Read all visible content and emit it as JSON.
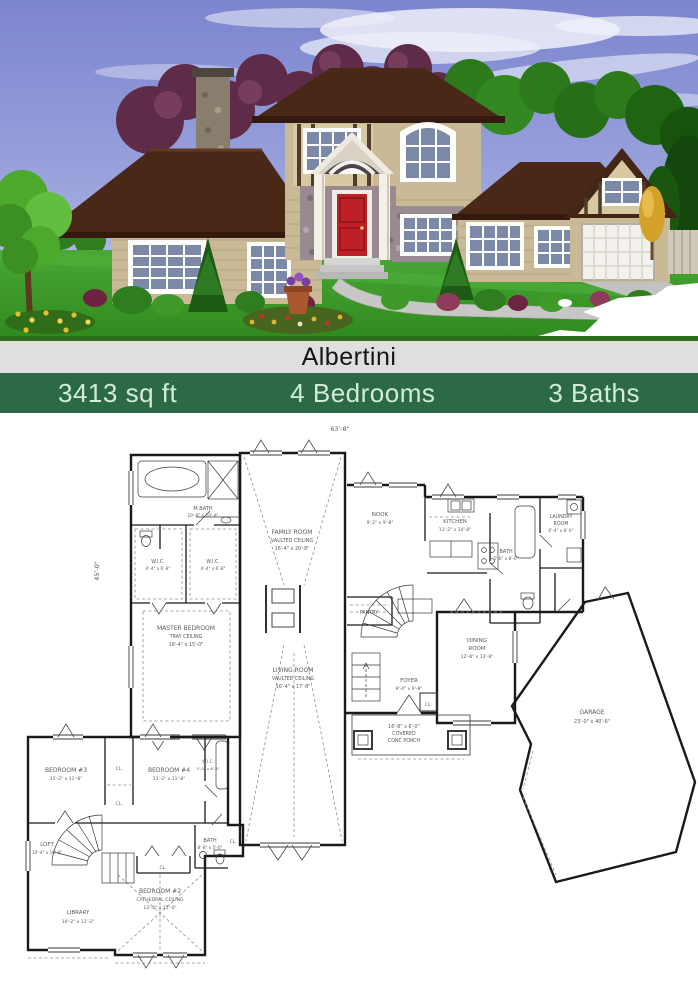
{
  "title": "Albertini",
  "stats": {
    "sqft": "3413 sq ft",
    "bedrooms": "4 Bedrooms",
    "baths": "3 Baths"
  },
  "colors": {
    "title_bg": "#e0dfdd",
    "title_text": "#141414",
    "stats_bg": "#2c6947",
    "stats_text": "#d2ecdc",
    "roof": "#4a2817",
    "wall_siding": "#c9b996",
    "front_door": "#bf2026",
    "lawn": "#3fa02c",
    "sky": "#7c85cf",
    "plan_line": "#1a1a1a"
  },
  "fp1": {
    "dim_width": "63'-8\"",
    "dim_depth": "45'-0\"",
    "cl": "CL.",
    "mbath": {
      "name": "M.BATH",
      "dims": "10'-8\" x 10'-8\""
    },
    "wic1": {
      "name": "W.I.C.",
      "dims": "4'-4\" x 6'-8\""
    },
    "wic2": {
      "name": "W.I.C.",
      "dims": "4'-4\" x 6'-8\""
    },
    "family": {
      "name": "FAMILY ROOM",
      "sub": "VAULTED CEILING",
      "dims": "16'-4\" x 20'-8\""
    },
    "nook": {
      "name": "NOOK",
      "dims": "9'-2\" x 9'-8\""
    },
    "kitchen": {
      "name": "KITCHEN",
      "dims": "11'-2\" x 14'-8\""
    },
    "bath": {
      "name": "BATH",
      "dims": "5'-6\" x 8'-0\""
    },
    "laundry": {
      "name": "LAUNDRY",
      "name2": "ROOM",
      "dims": "6'-4\" x 8'-0\""
    },
    "pantry": {
      "name": "PANTRY"
    },
    "master": {
      "name": "MASTER BEDROOM",
      "sub": "TRAY CEILING",
      "dims": "16'-4\" x 15'-0\""
    },
    "living": {
      "name": "LIVING ROOM",
      "sub": "VAULTED CEILING",
      "dims": "16'-4\" x 17'-8\""
    },
    "foyer": {
      "name": "FOYER",
      "dims": "9'-4\" x 9'-8\""
    },
    "dining": {
      "name": "DINING",
      "name2": "ROOM",
      "dims": "12'-8\" x 13'-8\""
    },
    "porch": {
      "line1": "16'-8\" x 6'-0\"",
      "line2": "COVERED",
      "line3": "CONC PORCH"
    },
    "garage": {
      "name": "GARAGE",
      "dims": "23'-0\" x 40'-6\""
    }
  },
  "fp2": {
    "cl": "CL.",
    "bed3": {
      "name": "BEDROOM #3",
      "dims": "11'-2\" x 11'-8\""
    },
    "bed4": {
      "name": "BEDROOM #4",
      "dims": "11'-2\" x 11'-8\""
    },
    "wic": {
      "name": "W.I.C.",
      "dims": "5'-0\" x 6'-8\""
    },
    "bath": {
      "name": "BATH",
      "dims": "8'-8\" x 5'-0\""
    },
    "loft": {
      "name": "LOFT",
      "dims": "10'-4\" x 10'-8\""
    },
    "library": {
      "name": "LIBRARY",
      "dims": "10'-2\" x 11'-2\""
    },
    "bed2": {
      "name": "BEDROOM #2",
      "sub": "CATHEDRAL CEILING",
      "dims": "13'-4\" x 15'-0\""
    }
  }
}
